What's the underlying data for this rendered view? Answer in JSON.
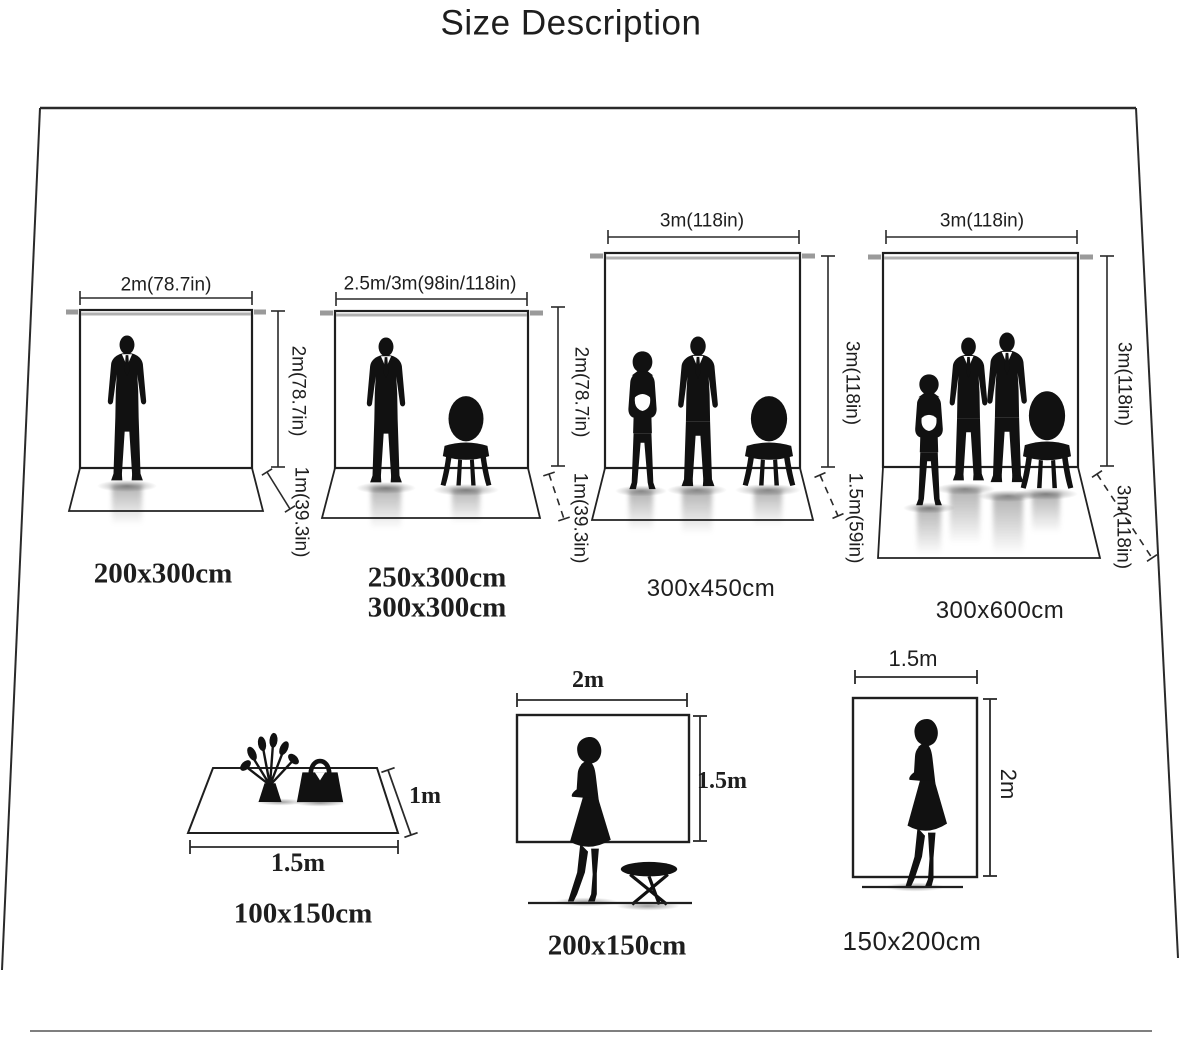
{
  "title": "Size Description",
  "colors": {
    "ink": "#1e1e1e",
    "line": "#2a2a2a",
    "crossbar": "#9a9a9a",
    "background": "#ffffff"
  },
  "backdrops": [
    {
      "name": "backdrop-200x300",
      "width": "2m(78.7in)",
      "height": "2m(78.7in)",
      "floor_depth": "1m(39.3in)",
      "sizes": [
        "200x300cm"
      ]
    },
    {
      "name": "backdrop-250x300-300x300",
      "width": "2.5m/3m(98in/118in)",
      "height": "2m(78.7in)",
      "floor_depth": "1m(39.3in)",
      "sizes": [
        "250x300cm",
        "300x300cm"
      ]
    },
    {
      "name": "backdrop-300x450",
      "width": "3m(118in)",
      "height": "3m(118in)",
      "floor_depth": "1.5m(59in)",
      "sizes": [
        "300x450cm"
      ]
    },
    {
      "name": "backdrop-300x600",
      "width": "3m(118in)",
      "height": "3m(118in)",
      "floor_depth": "3m(118in)",
      "sizes": [
        "300x600cm"
      ]
    }
  ],
  "small_items": [
    {
      "name": "mat-100x150",
      "width": "1.5m",
      "depth": "1m",
      "size": "100x150cm"
    },
    {
      "name": "backdrop-200x150",
      "width": "2m",
      "height": "1.5m",
      "size": "200x150cm"
    },
    {
      "name": "backdrop-150x200",
      "width": "1.5m",
      "height": "2m",
      "size": "150x200cm"
    }
  ]
}
